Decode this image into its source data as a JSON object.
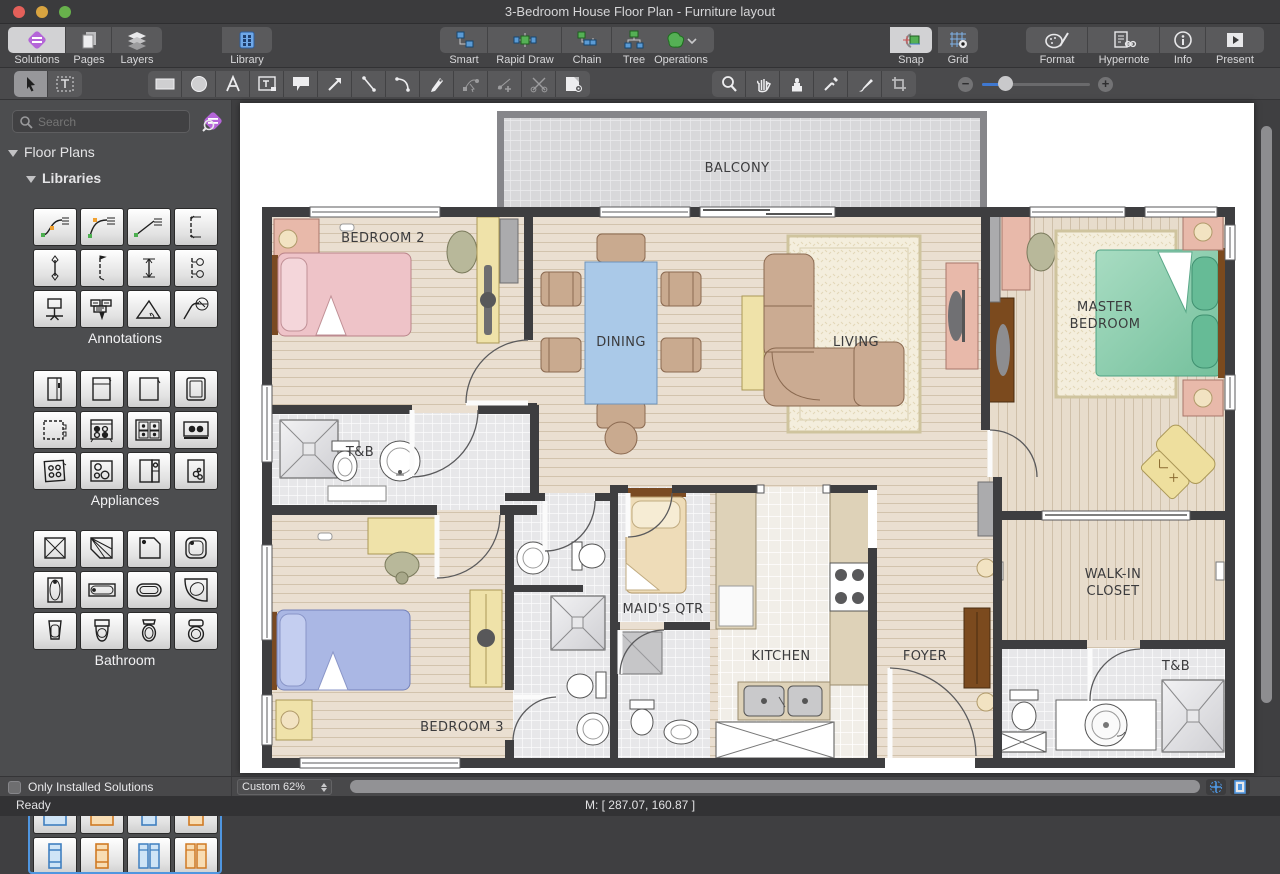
{
  "window": {
    "title": "3-Bedroom House Floor Plan - Furniture layout"
  },
  "toolbar": {
    "solutions": "Solutions",
    "pages": "Pages",
    "layers": "Layers",
    "library": "Library",
    "smart": "Smart",
    "rapid_draw": "Rapid Draw",
    "chain": "Chain",
    "tree": "Tree",
    "operations": "Operations",
    "snap": "Snap",
    "grid": "Grid",
    "format": "Format",
    "hypernote": "Hypernote",
    "info": "Info",
    "present": "Present"
  },
  "tools": [
    "select",
    "text-select",
    "rectangle",
    "ellipse",
    "text",
    "text-block",
    "callout",
    "arrow",
    "line",
    "curve",
    "pen",
    "reshape",
    "add-node",
    "cut",
    "shape-format",
    "zoom",
    "pan",
    "stamp",
    "eyedropper",
    "brush",
    "crop"
  ],
  "sidebar": {
    "search_placeholder": "Search",
    "tree": {
      "floor_plans": "Floor Plans",
      "libraries": "Libraries"
    },
    "palettes": {
      "annotations": {
        "label": "Annotations",
        "items": [
          "curve-callout-1",
          "curve-callout-2",
          "line-callout",
          "dimension-vertical",
          "axis-line",
          "dimension-flag",
          "dimension-double",
          "level-markers",
          "node-callout",
          "box-callout",
          "angle-marker",
          "radius-marker"
        ]
      },
      "appliances": {
        "label": "Appliances",
        "items": [
          "fridge-single",
          "fridge-top-freezer",
          "fridge-plain",
          "freezer",
          "dishwasher",
          "range-4-burner",
          "gas-cooktop",
          "cooker-hood",
          "oven-4",
          "cooktop-2",
          "washer-column",
          "mini-cooktop"
        ]
      },
      "bathroom": {
        "label": "Bathroom",
        "items": [
          "shower-square",
          "shower-corner",
          "shower-pentagon",
          "shower-round",
          "tub-vertical",
          "tub-built-in",
          "tub-oval",
          "tub-corner",
          "toilet-1",
          "toilet-2",
          "toilet-3",
          "bidet"
        ]
      },
      "beds": {
        "items": [
          "double-bed-blue",
          "double-bed-orange",
          "single-bed-blue",
          "single-bed-orange",
          "single-vert-blue",
          "single-vert-orange",
          "twin-vert-blue",
          "twin-vert-orange"
        ]
      }
    },
    "only_installed": "Only Installed Solutions"
  },
  "statusbar": {
    "ready": "Ready",
    "zoom": "Custom 62%",
    "mouse": "M: [ 287.07, 160.87 ]"
  },
  "plan": {
    "rooms": {
      "balcony": "BALCONY",
      "bedroom2": "BEDROOM 2",
      "dining": "DINING",
      "living": "LIVING",
      "master1": "MASTER",
      "master2": "BEDROOM",
      "tnb1": "T&B",
      "maid": "MAID'S QTR",
      "kitchen": "KITCHEN",
      "foyer": "FOYER",
      "walkin1": "WALK-IN",
      "walkin2": "CLOSET",
      "bedroom3": "BEDROOM 3",
      "tnb2": "T&B"
    }
  }
}
